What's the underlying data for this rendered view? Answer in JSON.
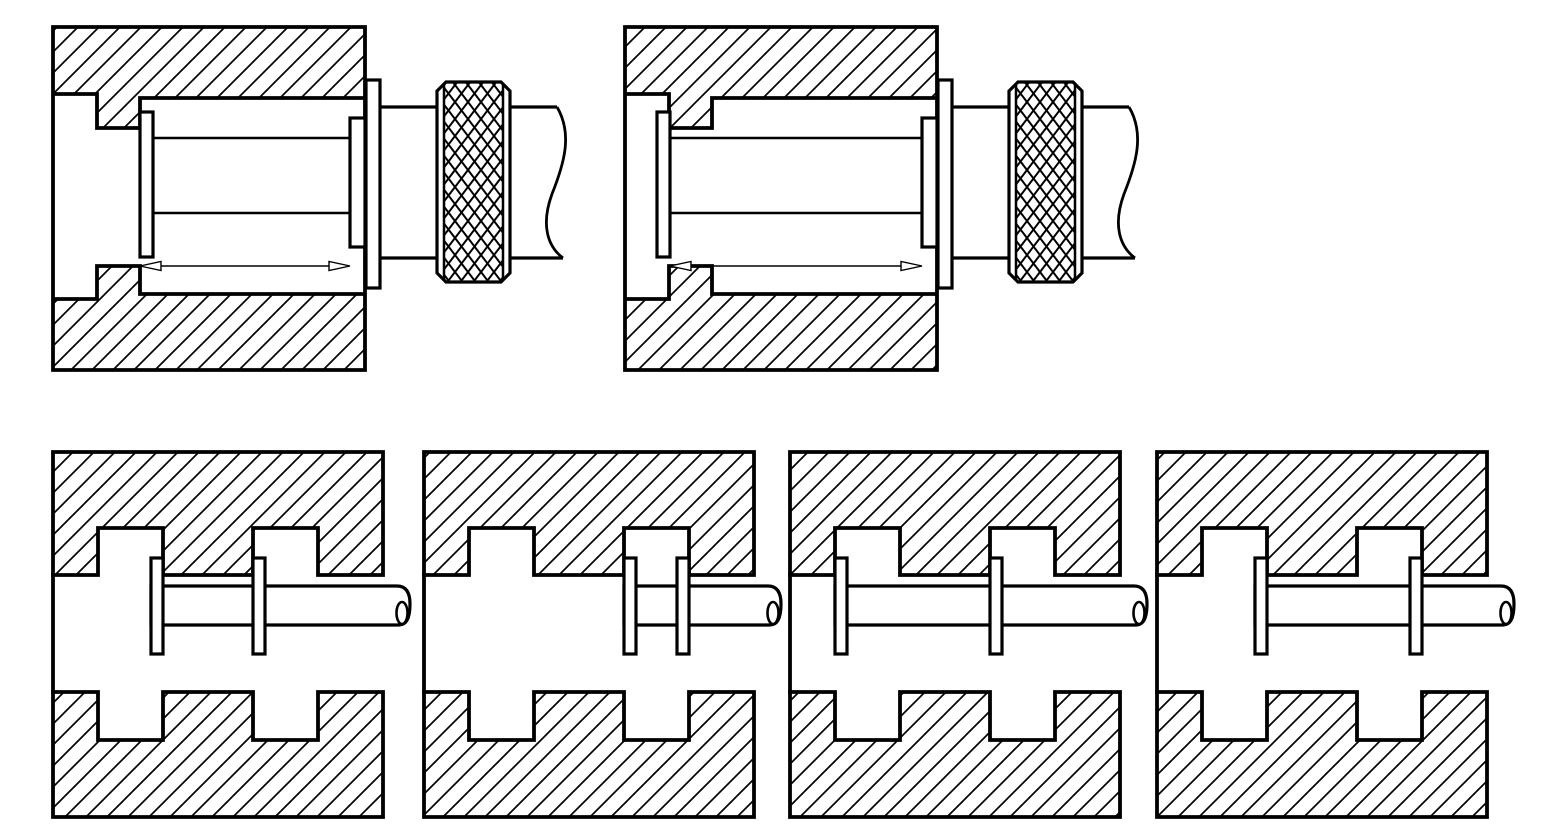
{
  "page": {
    "background": "#ffffff",
    "ink": "#000000",
    "description": "Engineering cross-section drawing: knurled-knob plunger assembly shown in two positions (top row) and a twin-flange shaft shown in four detent positions inside slotted die blocks (bottom row)"
  },
  "top_row": {
    "assemblies": [
      {
        "id": "assembly-1",
        "x": 53,
        "flange_side": "after-step"
      },
      {
        "id": "assembly-2",
        "x": 625,
        "flange_side": "before-step"
      }
    ]
  },
  "bottom_row": {
    "blocks": [
      {
        "id": "block-1",
        "x": 53,
        "flanges": [
          {
            "slot": 1,
            "edge": "right"
          },
          {
            "slot": 2,
            "edge": "left"
          }
        ]
      },
      {
        "id": "block-2",
        "x": 424,
        "flanges": [
          {
            "slot": 2,
            "edge": "left"
          },
          {
            "slot": 2,
            "edge": "right"
          }
        ]
      },
      {
        "id": "block-3",
        "x": 790,
        "flanges": [
          {
            "slot": 1,
            "edge": "left"
          },
          {
            "slot": 2,
            "edge": "left"
          }
        ]
      },
      {
        "id": "block-4",
        "x": 1157,
        "flanges": [
          {
            "slot": 1,
            "edge": "right"
          },
          {
            "slot": 2,
            "edge": "right"
          }
        ]
      }
    ]
  },
  "geometry": {
    "canvas": {
      "width": 1550,
      "height": 839
    },
    "top": {
      "block_y": [
        27,
        370
      ],
      "block_w": 312,
      "recess_w": 44,
      "tooth_w": 43,
      "recess_y": [
        94,
        299
      ],
      "bore_y": [
        98,
        294
      ],
      "tooth_inner_y": [
        128,
        266
      ],
      "flange": {
        "w": 13,
        "y": [
          112,
          257
        ]
      },
      "inner_flange": {
        "w": 15,
        "y": [
          118,
          247
        ]
      },
      "sleeve_y": [
        138,
        213
      ],
      "arrow_y": 266,
      "arrow_head_len": 21,
      "arrow_head_half": 4.5,
      "plate": {
        "w": 14,
        "y": [
          80,
          288
        ]
      },
      "shaft_y": [
        107,
        258
      ],
      "knob": {
        "offset": 72,
        "w": 73,
        "y": [
          82,
          282
        ],
        "chamfer": 9,
        "band": 7
      },
      "shaft2_len": 47
    },
    "bottom": {
      "block_y": [
        452,
        817
      ],
      "block_w": 330,
      "face_y": [
        575,
        692
      ],
      "slot_top": 528,
      "notch_bottom": 740,
      "slot1_x": [
        45,
        110
      ],
      "slot2_x": [
        200,
        265
      ],
      "flange": {
        "w": 12,
        "y": [
          558,
          654
        ]
      },
      "shaft_y": [
        586,
        625
      ],
      "tip_offset": 357
    },
    "style": {
      "block_stroke": 3.8,
      "outline": 3.2,
      "detail": 2.5,
      "thin": 1.4,
      "break_stroke": 2.8,
      "hatch_spacing": 21,
      "hatch_stroke": 1.7,
      "knurl_cell": [
        13,
        17
      ],
      "knurl_stroke": 2
    }
  }
}
